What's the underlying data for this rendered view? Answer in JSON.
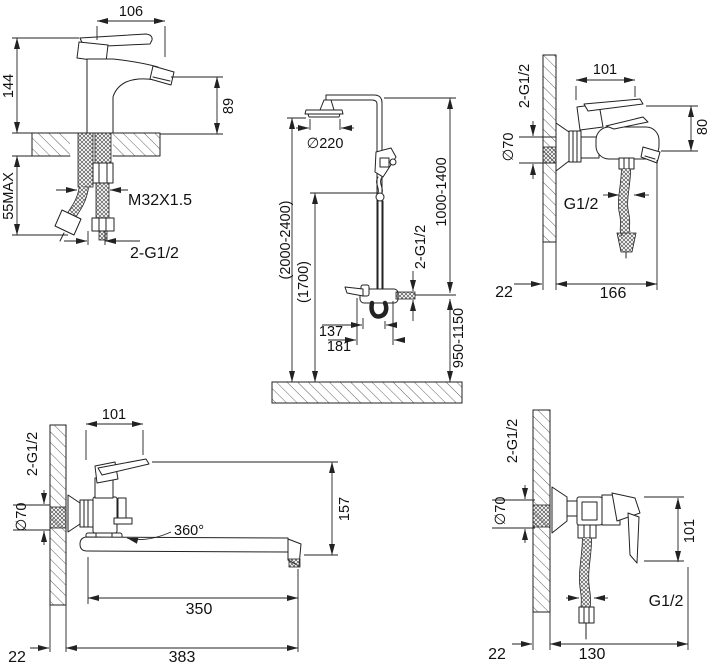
{
  "figure": {
    "type": "technical-dimensional-drawing",
    "subject": "faucet and shower set installation dimensions",
    "background_color": "#ffffff",
    "line_color": "#222222"
  },
  "drawings": [
    {
      "id": "basin-faucet",
      "dims": {
        "spout_width": "106",
        "total_height": "144",
        "spout_height": "89",
        "max_deck": "55MAX",
        "mount_thread": "M32X1.5",
        "hose_thread": "2-G1/2"
      }
    },
    {
      "id": "shower-column",
      "dims": {
        "head_diameter": "∅220",
        "total_height": "(2000-2400)",
        "handshower_height": "(1700)",
        "riser_range": "1000-1400",
        "inlet_thread": "2-G1/2",
        "spout_offset": "137",
        "total_offset": "181",
        "mixer_height": "950-1150"
      }
    },
    {
      "id": "bath-mixer",
      "dims": {
        "body_width": "101",
        "inlet_thread": "2-G1/2",
        "escutcheon_diameter": "∅70",
        "body_height": "80",
        "hose_thread": "G1/2",
        "wall_gap": "22",
        "reach": "166"
      }
    },
    {
      "id": "long-spout-mixer",
      "dims": {
        "body_width": "101",
        "inlet_thread": "2-G1/2",
        "escutcheon_diameter": "∅70",
        "swivel_angle": "360°",
        "height": "157",
        "spout_length": "350",
        "wall_gap": "22",
        "total_reach": "383"
      }
    },
    {
      "id": "shower-valve",
      "dims": {
        "inlet_thread": "2-G1/2",
        "escutcheon_diameter": "∅70",
        "body_height": "101",
        "hose_thread": "G1/2",
        "wall_gap": "22",
        "reach": "130"
      }
    }
  ]
}
